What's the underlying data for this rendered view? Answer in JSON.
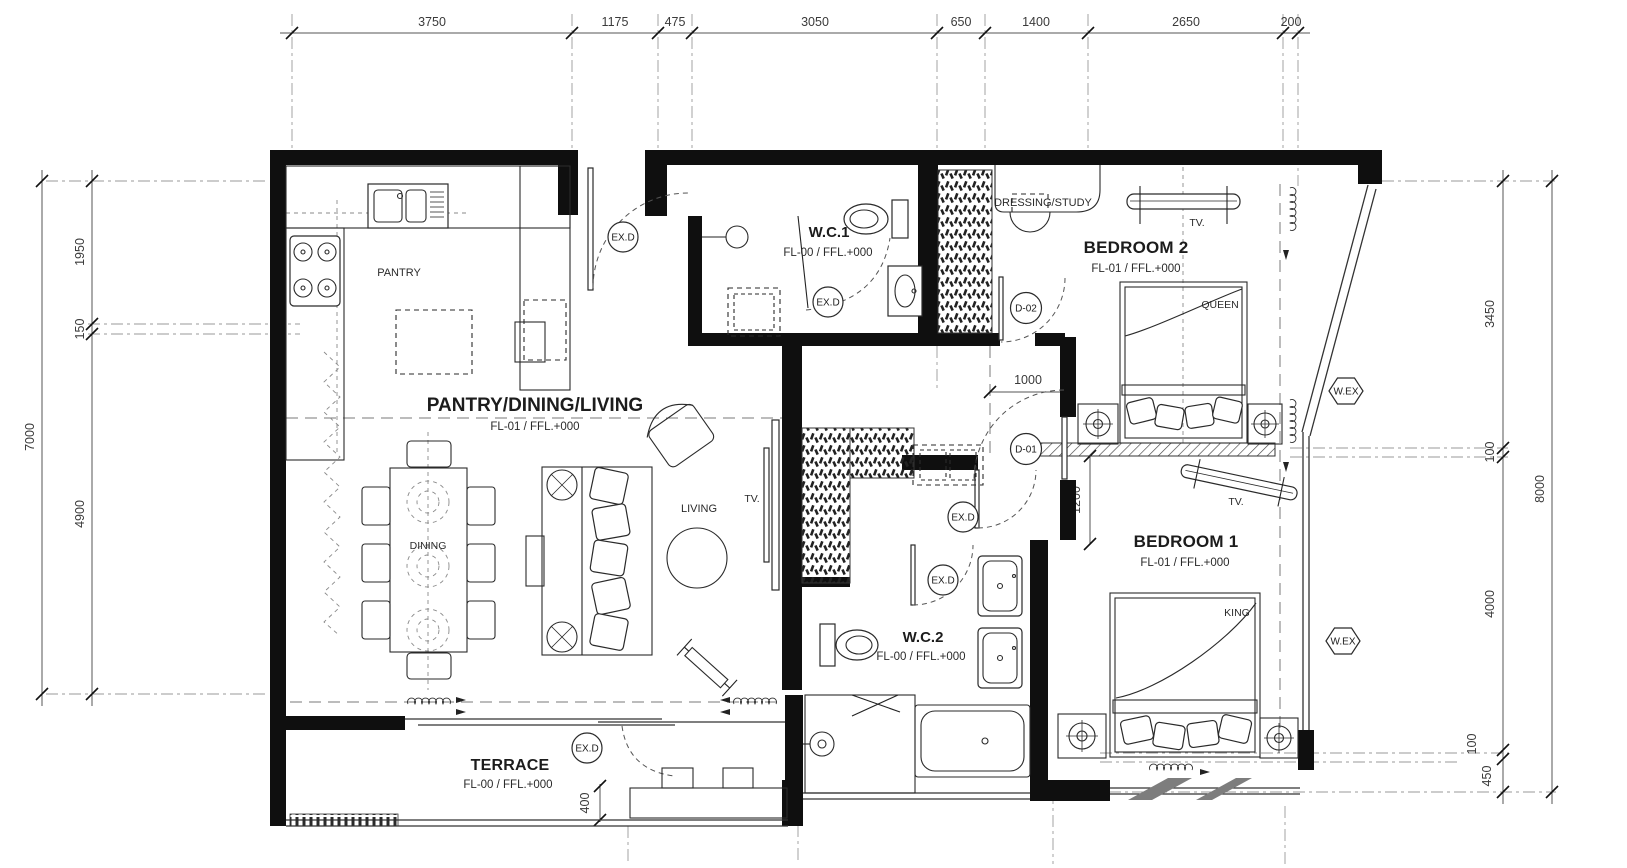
{
  "plan": {
    "dims": {
      "top": [
        "3750",
        "1175",
        "475",
        "3050",
        "650",
        "1400",
        "2650",
        "200"
      ],
      "left_inner": [
        "1950",
        "150",
        "4900"
      ],
      "left_outer": "7000",
      "right_inner": [
        "3450",
        "100",
        "4000",
        "100",
        "450"
      ],
      "right_outer": "8000",
      "internal": {
        "corridor": "1000",
        "bedroom1": "1200",
        "terrace": "400"
      }
    },
    "rooms": {
      "pantry": {
        "name": "PANTRY"
      },
      "wc1": {
        "name": "W.C.1",
        "level": "FL-00 / FFL.+000"
      },
      "dressing": {
        "name": "DRESSING/STUDY"
      },
      "bedroom2": {
        "name": "BEDROOM 2",
        "level": "FL-01 / FFL.+000",
        "bed": "QUEEN",
        "tv": "TV."
      },
      "living": {
        "name": "PANTRY/DINING/LIVING",
        "level": "FL-01 / FFL.+000",
        "dining": "DINING",
        "living": "LIVING",
        "tv": "TV."
      },
      "wc2": {
        "name": "W.C.2",
        "level": "FL-00 / FFL.+000"
      },
      "bedroom1": {
        "name": "BEDROOM 1",
        "level": "FL-01 / FFL.+000",
        "bed": "KING",
        "tv": "TV."
      },
      "terrace": {
        "name": "TERRACE",
        "level": "FL-00 / FFL.+000"
      }
    },
    "tags": {
      "exit_door": "EX.D",
      "door1": "D-01",
      "door2": "D-02",
      "window_ex": "W.EX"
    }
  },
  "colors": {
    "wall": "#0f0f0f",
    "line": "#2a2a2a",
    "dim": "#3a3a3a",
    "grid": "#9a9a9a",
    "watermark": "#7d7d7d",
    "background": "#ffffff"
  }
}
